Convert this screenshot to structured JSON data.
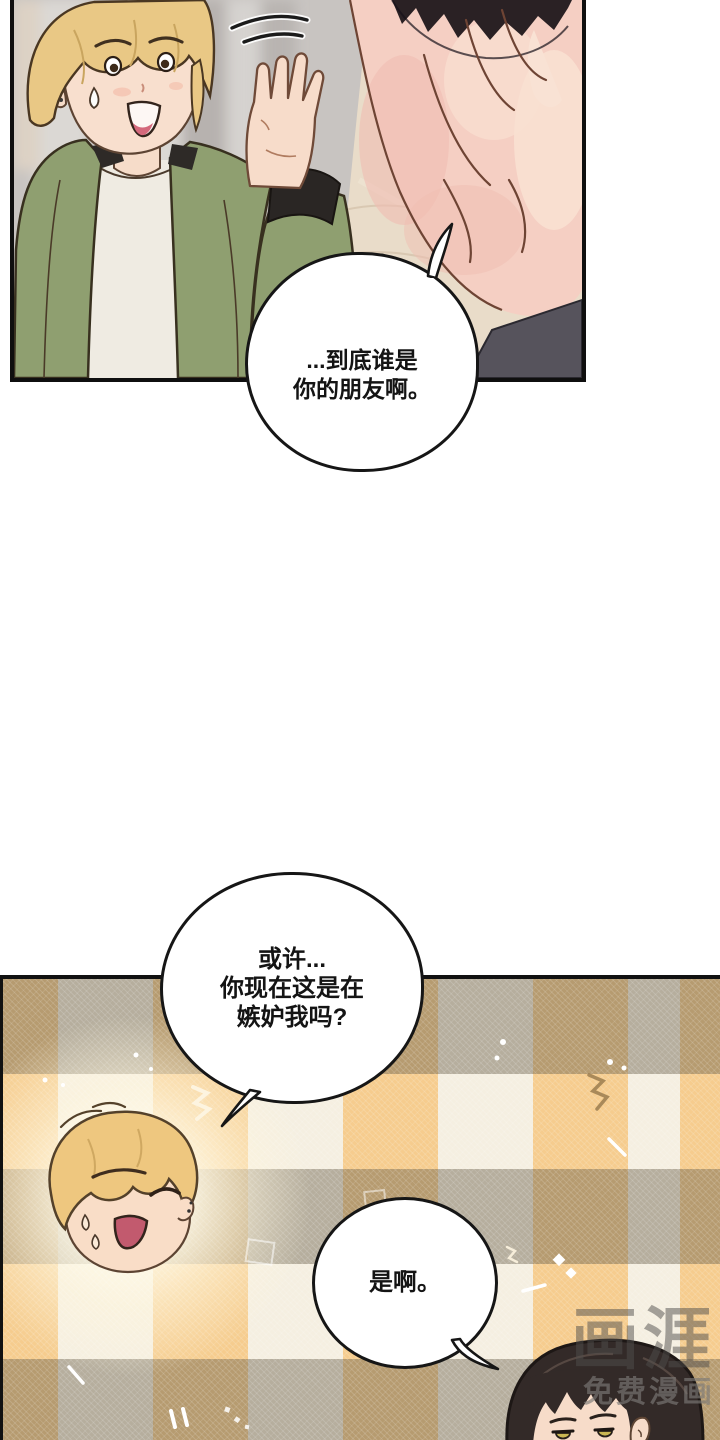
{
  "dialogue": {
    "bubble1": {
      "lines": [
        "...到底谁是",
        "你的朋友啊。"
      ]
    },
    "bubble2": {
      "lines": [
        "或许...",
        "你现在这是在",
        "嫉妒我吗?"
      ]
    },
    "bubble3": {
      "lines": [
        "是啊。"
      ]
    }
  },
  "watermark": {
    "logo": "画涯",
    "tagline": "免费漫画"
  },
  "decorations": {
    "motion_swoosh": "motion-lines",
    "sparkle_types": [
      "zigzag",
      "dot",
      "slash",
      "diamond",
      "square-outline"
    ]
  },
  "palette": {
    "panel_bg_gray": "#c8c4c1",
    "table_beige": "#e9dcc9",
    "jacket_green": "#8f9f70",
    "blond_hair": "#e9c885",
    "skin": "#f8dfce",
    "closeup_skin_pink": "#f5cfc3",
    "dark_hair": "#2a2124",
    "plaid_cream": "#f5efe1",
    "plaid_orange": "#f2c983",
    "plaid_gray": "#b5ad9a",
    "bubble_outline": "#161616",
    "eye_yellow": "#c9b652",
    "watermark_gray": "#6b6966"
  }
}
